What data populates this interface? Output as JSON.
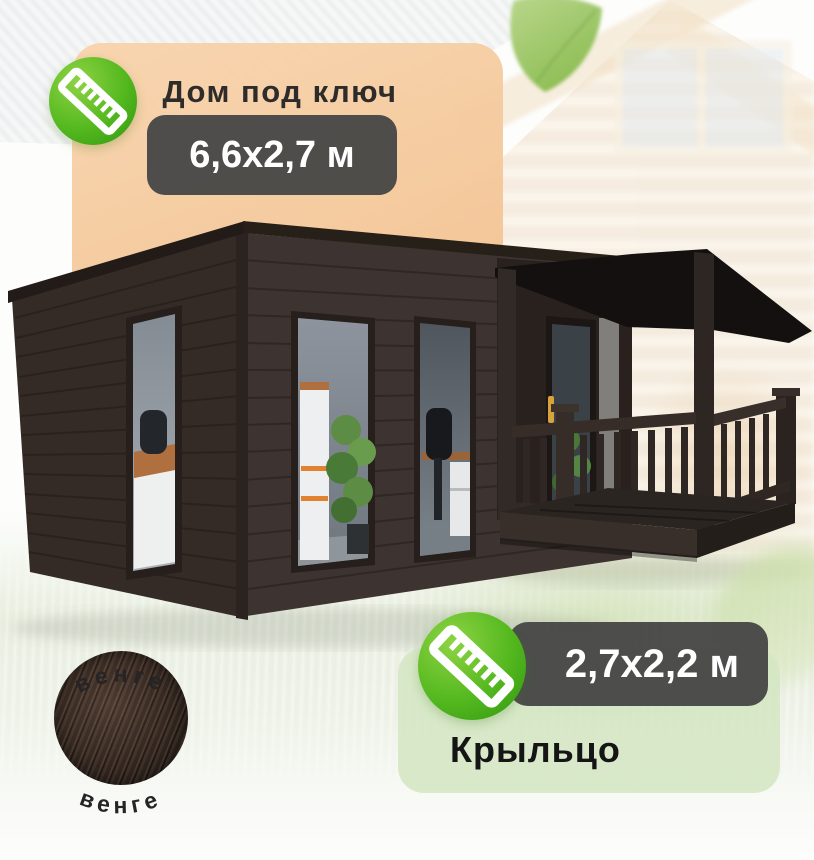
{
  "house_card": {
    "title": "Дом под ключ",
    "size": "6,6х2,7 м"
  },
  "porch_card": {
    "size": "2,7х2,2 м",
    "label": "Крыльцо"
  },
  "material_swatch": {
    "top_label": "венге",
    "bottom_label": "венге"
  },
  "icons": {
    "house_card_icon": "ruler-icon",
    "porch_card_icon": "ruler-icon"
  },
  "colors": {
    "accent_green": "#4CB31C",
    "badge_dark": "#474747",
    "panel_peach": "#F5CBA2",
    "panel_green": "#D6E7C7",
    "house_wenge": "#38302C",
    "leaf_green": "#9EC167",
    "swatch_wood": "#43342D"
  }
}
